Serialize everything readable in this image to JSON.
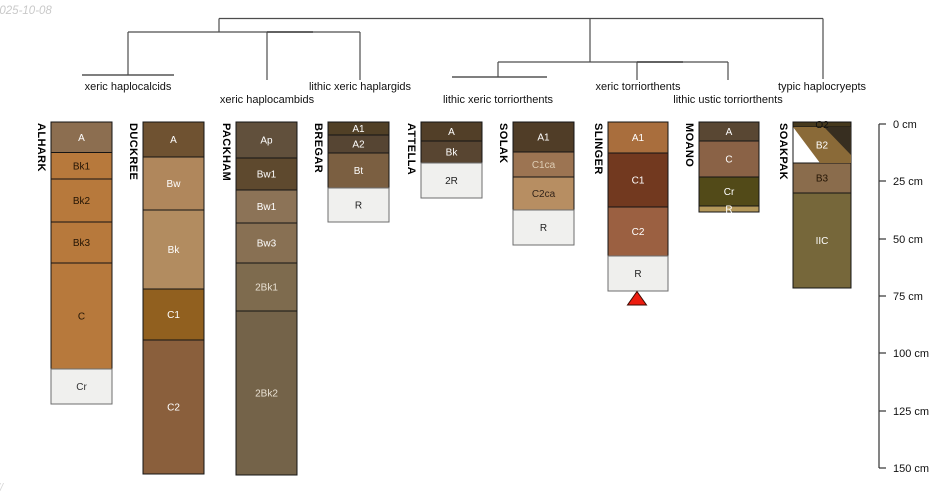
{
  "watermarks": {
    "date": "2025-10-08",
    "corner": "//"
  },
  "dendrogram": {
    "color": "#4d4d4d",
    "h_lines": [
      {
        "x1": 219,
        "x2": 823,
        "y": 18.5,
        "color": "#4d4d4d"
      },
      {
        "x1": 128,
        "x2": 360,
        "y": 32,
        "color": "#4d4d4d"
      },
      {
        "x1": 267,
        "x2": 313,
        "y": 32,
        "color": "#1f1f1f"
      },
      {
        "x1": 498,
        "x2": 728,
        "y": 62,
        "color": "#4d4d4d"
      },
      {
        "x1": 637,
        "x2": 683,
        "y": 62,
        "color": "#1f1f1f"
      },
      {
        "x1": 82,
        "x2": 174,
        "y": 75,
        "color": "#333333"
      },
      {
        "x1": 452,
        "x2": 547,
        "y": 77,
        "color": "#333333"
      }
    ],
    "v_lines": [
      {
        "x": 219,
        "y1": 18.5,
        "y2": 32
      },
      {
        "x": 590,
        "y1": 18.5,
        "y2": 62
      },
      {
        "x": 823,
        "y1": 18.5,
        "y2": 79
      },
      {
        "x": 128,
        "y1": 32,
        "y2": 75
      },
      {
        "x": 267,
        "y1": 32,
        "y2": 80
      },
      {
        "x": 360,
        "y1": 32,
        "y2": 80
      },
      {
        "x": 498,
        "y1": 62,
        "y2": 77
      },
      {
        "x": 637,
        "y1": 62,
        "y2": 80
      },
      {
        "x": 728,
        "y1": 62,
        "y2": 80
      }
    ],
    "labels": [
      {
        "text": "xeric haplocalcids",
        "x": 128,
        "y": 90
      },
      {
        "text": "xeric haplocambids",
        "x": 267,
        "y": 103
      },
      {
        "text": "lithic xeric haplargids",
        "x": 360,
        "y": 90
      },
      {
        "text": "lithic xeric torriorthents",
        "x": 498,
        "y": 103
      },
      {
        "text": "xeric torriorthents",
        "x": 638,
        "y": 90
      },
      {
        "text": "lithic ustic torriorthents",
        "x": 728,
        "y": 103
      },
      {
        "text": "typic haplocryepts",
        "x": 822,
        "y": 90
      }
    ]
  },
  "profiles": [
    {
      "name": "ALHARK",
      "x": 51,
      "w": 61,
      "horizons": [
        {
          "label": "A",
          "top": 122,
          "bottom": 152.5,
          "fill": "#8c6e50",
          "text": "#ffffff"
        },
        {
          "label": "Bk1",
          "top": 152.5,
          "bottom": 179,
          "fill": "#b7793c",
          "text": "#241505"
        },
        {
          "label": "Bk2",
          "top": 179,
          "bottom": 222,
          "fill": "#b7793c",
          "text": "#241505"
        },
        {
          "label": "Bk3",
          "top": 222,
          "bottom": 263,
          "fill": "#b7793c",
          "text": "#241505"
        },
        {
          "label": "C",
          "top": 263,
          "bottom": 369,
          "fill": "#b7793c",
          "text": "#241505"
        },
        {
          "label": "Cr",
          "top": 369,
          "bottom": 404,
          "fill": "#f0f0ee",
          "text": "#333333",
          "rock": true
        }
      ]
    },
    {
      "name": "DUCKREE",
      "x": 143,
      "w": 61,
      "horizons": [
        {
          "label": "A",
          "top": 122,
          "bottom": 157,
          "fill": "#6f5231",
          "text": "#ffffff"
        },
        {
          "label": "Bw",
          "top": 157,
          "bottom": 210,
          "fill": "#b0875c",
          "text": "#ffffff"
        },
        {
          "label": "Bk",
          "top": 210,
          "bottom": 289,
          "fill": "#b28c60",
          "text": "#ffffff"
        },
        {
          "label": "C1",
          "top": 289,
          "bottom": 340,
          "fill": "#91601f",
          "text": "#ffffff"
        },
        {
          "label": "C2",
          "top": 340,
          "bottom": 474,
          "fill": "#8a5f3c",
          "text": "#ffffff"
        }
      ]
    },
    {
      "name": "PACKHAM",
      "x": 236,
      "w": 61,
      "horizons": [
        {
          "label": "Ap",
          "top": 122,
          "bottom": 158,
          "fill": "#61503c",
          "text": "#ffffff"
        },
        {
          "label": "Bw1",
          "top": 158,
          "bottom": 190,
          "fill": "#5e492e",
          "text": "#ffffff"
        },
        {
          "label": "Bw1",
          "top": 190,
          "bottom": 223,
          "fill": "#8c7357",
          "text": "#ffffff"
        },
        {
          "label": "Bw3",
          "top": 223,
          "bottom": 263,
          "fill": "#887053",
          "text": "#ffffff"
        },
        {
          "label": "2Bk1",
          "top": 263,
          "bottom": 311,
          "fill": "#7e6b4e",
          "text": "#e8e0d2"
        },
        {
          "label": "2Bk2",
          "top": 311,
          "bottom": 475,
          "fill": "#746349",
          "text": "#e8e0d2"
        }
      ]
    },
    {
      "name": "BREGAR",
      "x": 328,
      "w": 61,
      "horizons": [
        {
          "label": "A1",
          "top": 122,
          "bottom": 135,
          "fill": "#514026",
          "text": "#ffffff"
        },
        {
          "label": "A2",
          "top": 135,
          "bottom": 153,
          "fill": "#564533",
          "text": "#ffffff"
        },
        {
          "label": "Bt",
          "top": 153,
          "bottom": 188,
          "fill": "#7b5f41",
          "text": "#ffffff"
        },
        {
          "label": "R",
          "top": 188,
          "bottom": 222,
          "fill": "#f0f0ee",
          "text": "#222222",
          "rock": true
        }
      ]
    },
    {
      "name": "ATTELLA",
      "x": 421,
      "w": 61,
      "horizons": [
        {
          "label": "A",
          "top": 122,
          "bottom": 141,
          "fill": "#523f28",
          "text": "#ffffff"
        },
        {
          "label": "Bk",
          "top": 141,
          "bottom": 163,
          "fill": "#584531",
          "text": "#ffffff"
        },
        {
          "label": "2R",
          "top": 163,
          "bottom": 198,
          "fill": "#f0f0ee",
          "text": "#222222",
          "rock": true
        }
      ]
    },
    {
      "name": "SOLAK",
      "x": 513,
      "w": 61,
      "horizons": [
        {
          "label": "A1",
          "top": 122,
          "bottom": 152,
          "fill": "#503d27",
          "text": "#ffffff"
        },
        {
          "label": "C1ca",
          "top": 152,
          "bottom": 177,
          "fill": "#9c7452",
          "text": "#decdb4"
        },
        {
          "label": "C2ca",
          "top": 177,
          "bottom": 210,
          "fill": "#b78e62",
          "text": "#33241a"
        },
        {
          "label": "R",
          "top": 210,
          "bottom": 245,
          "fill": "#f0f0ee",
          "text": "#222222",
          "rock": true
        }
      ]
    },
    {
      "name": "SLINGER",
      "x": 608,
      "w": 60,
      "horizons": [
        {
          "label": "A1",
          "top": 122,
          "bottom": 153,
          "fill": "#a96e3d",
          "text": "#ffffff"
        },
        {
          "label": "C1",
          "top": 153,
          "bottom": 207,
          "fill": "#72391f",
          "text": "#ffffff"
        },
        {
          "label": "C2",
          "top": 207,
          "bottom": 256,
          "fill": "#9b6041",
          "text": "#ffffff"
        },
        {
          "label": "R",
          "top": 256,
          "bottom": 291,
          "fill": "#efefed",
          "text": "#222222",
          "rock": true
        }
      ]
    },
    {
      "name": "MOANO",
      "x": 699,
      "w": 60,
      "horizons": [
        {
          "label": "A",
          "top": 122,
          "bottom": 141,
          "fill": "#594733",
          "text": "#ffffff"
        },
        {
          "label": "C",
          "top": 141,
          "bottom": 177,
          "fill": "#8a6246",
          "text": "#ffffff"
        },
        {
          "label": "Cr",
          "top": 177,
          "bottom": 206,
          "fill": "#524a18",
          "text": "#ffffff"
        },
        {
          "label": "R",
          "top": 206,
          "bottom": 212,
          "fill": "#b4985a",
          "text": "#ffffff"
        }
      ]
    },
    {
      "name": "SOAKPAK",
      "x": 793,
      "w": 58,
      "horizons": [
        {
          "label": "O2",
          "top": 122,
          "bottom": 127,
          "fill": "#46391d",
          "text": "#111111"
        },
        {
          "label": "B2",
          "top": 127,
          "bottom": 163,
          "fill": "#ffffff",
          "text": "#ffffff"
        },
        {
          "label": "B3",
          "top": 163,
          "bottom": 193,
          "fill": "#8a6c4c",
          "text": "#241505"
        },
        {
          "label": "IIC",
          "top": 193,
          "bottom": 288,
          "fill": "#76673a",
          "text": "#ffffff"
        }
      ],
      "overlay": [
        {
          "name": "soakpak-b2-brown-band",
          "points": "793,127 851,127 851,163 820,163",
          "fill": "#8a6a38"
        },
        {
          "name": "soakpak-b2-dark-triangle",
          "points": "824,127 851,127 851,155",
          "fill": "#372e20"
        },
        {
          "name": "soakpak-b2-white-triangle",
          "points": "793.5,128 793.5,162.5 819,162.5",
          "fill": "#ffffff"
        }
      ]
    }
  ],
  "marker": {
    "points": "637,291.5 646.5,305 627.5,305",
    "fill": "#ec1c0f",
    "stroke": "#3c0c04"
  },
  "axis": {
    "x": 879,
    "y_top": 124,
    "y_bottom": 468,
    "tick_len": 7,
    "color": "#333333",
    "label_x": 893,
    "ticks": [
      {
        "label": "0 cm",
        "y": 124
      },
      {
        "label": "25 cm",
        "y": 181
      },
      {
        "label": "50 cm",
        "y": 239
      },
      {
        "label": "75 cm",
        "y": 296
      },
      {
        "label": "100 cm",
        "y": 353
      },
      {
        "label": "125 cm",
        "y": 411
      },
      {
        "label": "150 cm",
        "y": 468
      }
    ]
  }
}
